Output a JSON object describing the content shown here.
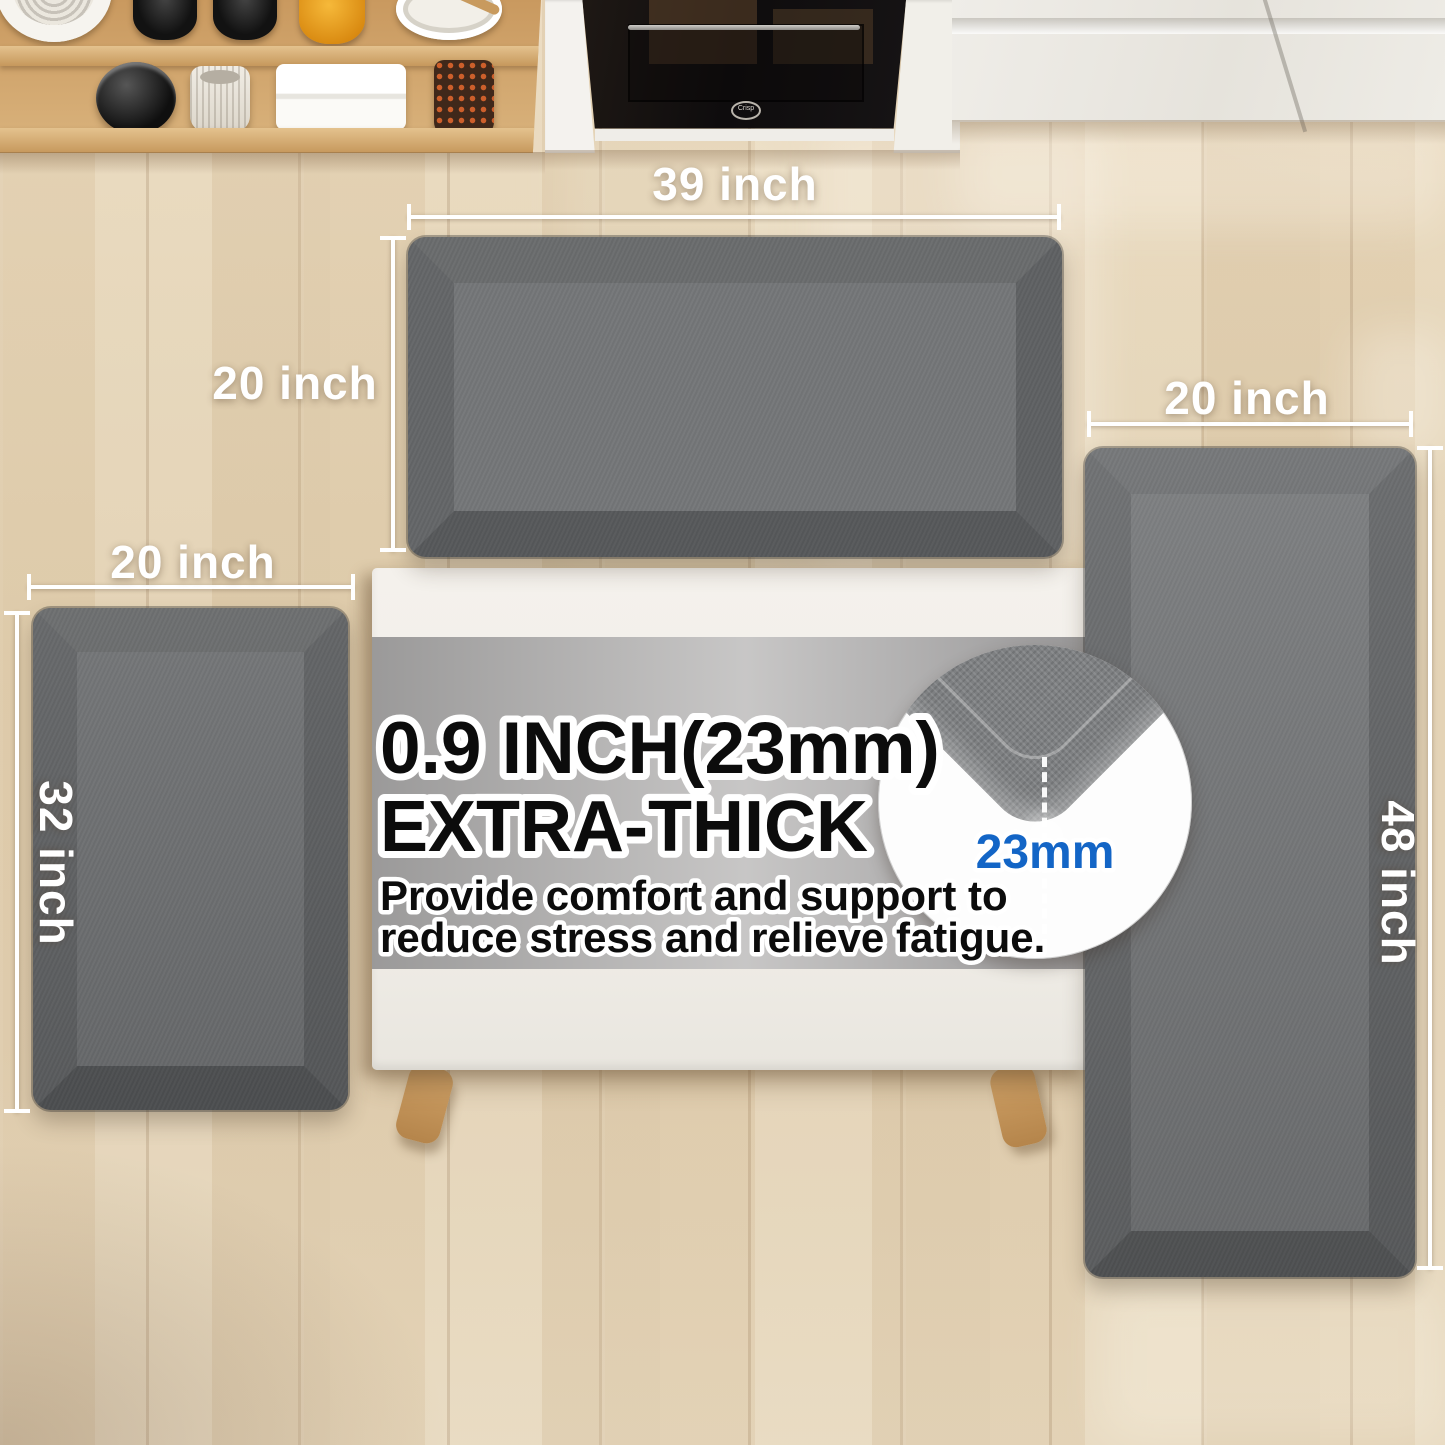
{
  "product_annotations": {
    "top_mat": {
      "width_label": "39 inch",
      "height_label": "20 inch"
    },
    "left_mat": {
      "width_label": "20 inch",
      "height_label": "32 inch"
    },
    "right_mat": {
      "width_label": "20 inch",
      "height_label": "48 inch"
    }
  },
  "thickness_callout": {
    "title_line1": "0.9 INCH(23mm)",
    "title_line2": "EXTRA-THICK",
    "body_line1": "Provide comfort and support to",
    "body_line2": "reduce stress and relieve fatigue.",
    "zoom_thickness_label": "23mm"
  },
  "appliances": {
    "oven_door_badge": "Crisp"
  },
  "colors": {
    "mat_surface_gray": "#747678",
    "dimension_label_white": "#ffffff",
    "thickness_label_blue": "#1365c6",
    "floor_wood_beige": "#e3d2b6",
    "shelf_wood": "#cfa368",
    "table_top_white": "#f2efe9"
  }
}
